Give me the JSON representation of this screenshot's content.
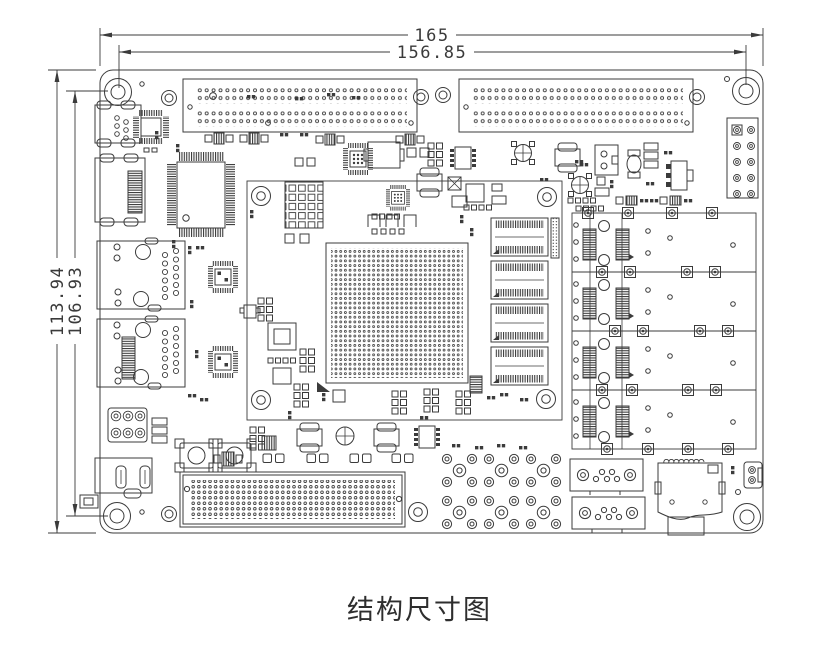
{
  "drawing": {
    "caption": "结构尺寸图",
    "dimensions": {
      "top_outer": "165",
      "top_inner": "156.85",
      "left_outer": "113.94",
      "left_inner": "106.93"
    },
    "colors": {
      "line": "#3b3b3b",
      "text": "#3a3a3a",
      "background": "#ffffff"
    }
  }
}
